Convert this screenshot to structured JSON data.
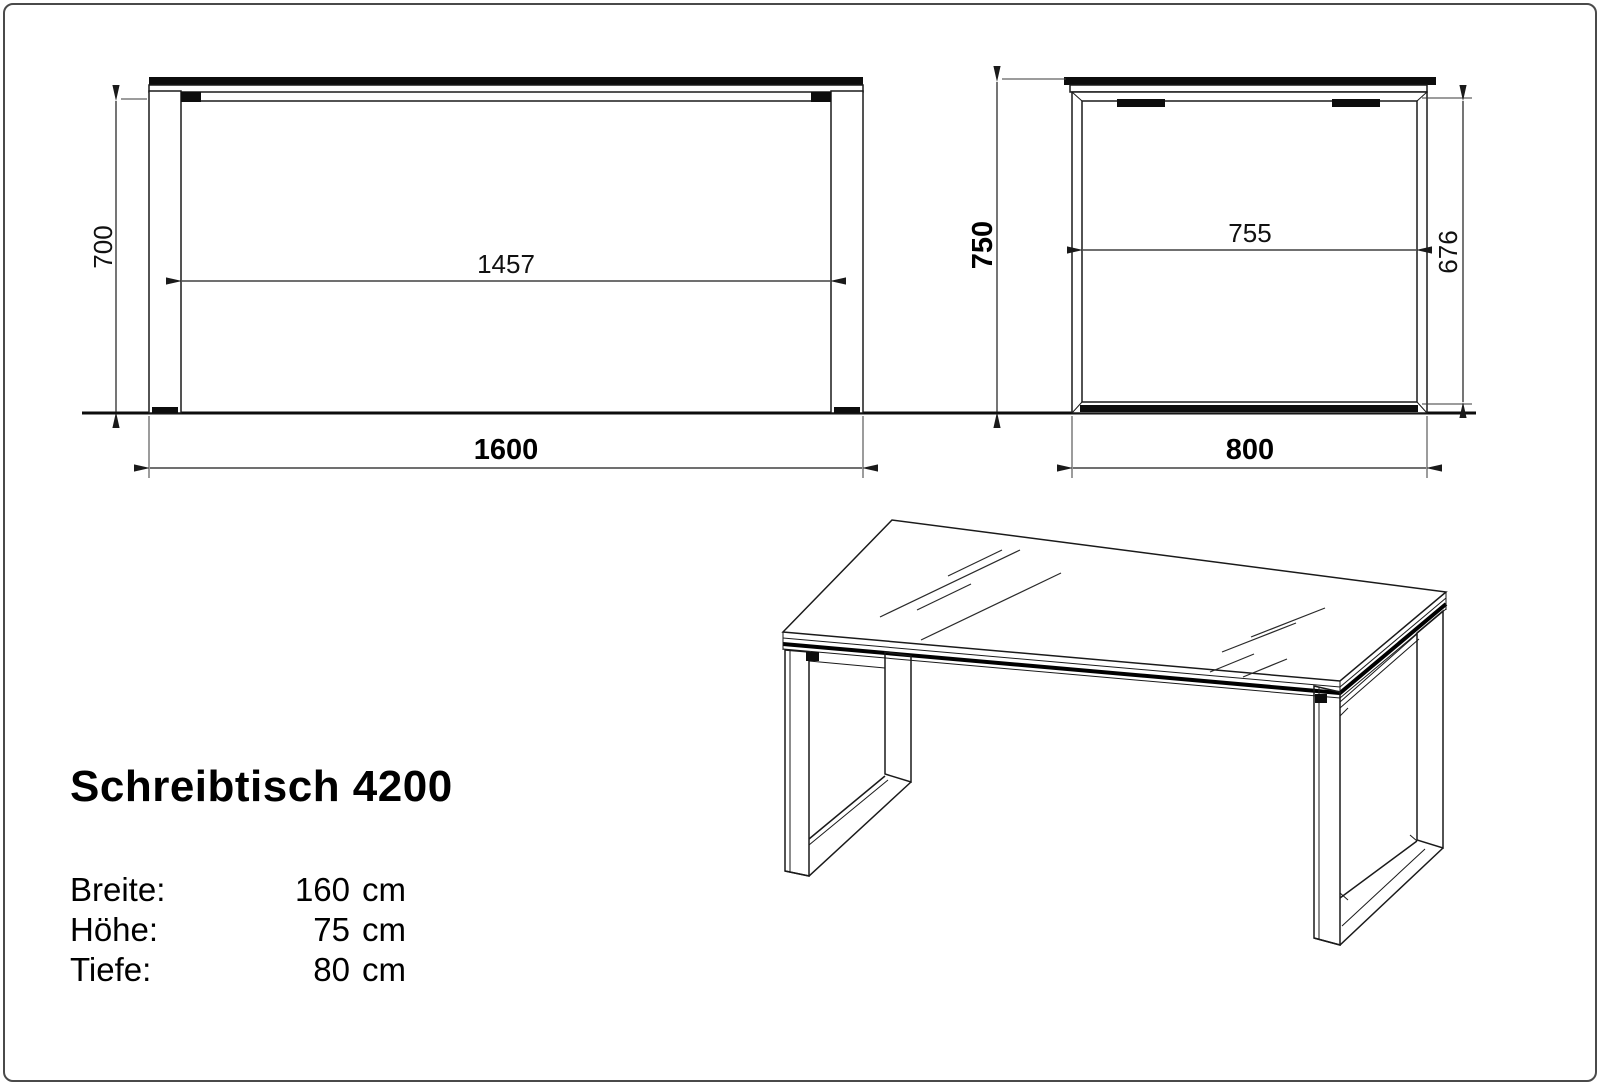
{
  "drawing": {
    "front_view": {
      "dim_clearance_height": "700",
      "dim_inner_width": "1457",
      "dim_total_width": "1600"
    },
    "side_view": {
      "dim_total_height": "750",
      "dim_inner_depth": "755",
      "dim_inner_height": "676",
      "dim_total_depth": "800"
    }
  },
  "title_block": {
    "model": "Schreibtisch 4200",
    "specs": [
      {
        "label": "Breite:",
        "value": "160",
        "unit": "cm"
      },
      {
        "label": "Höhe:",
        "value": "75",
        "unit": "cm"
      },
      {
        "label": "Tiefe:",
        "value": "80",
        "unit": "cm"
      }
    ]
  },
  "colors": {
    "line": "#1a1a1a",
    "background": "#ffffff"
  }
}
